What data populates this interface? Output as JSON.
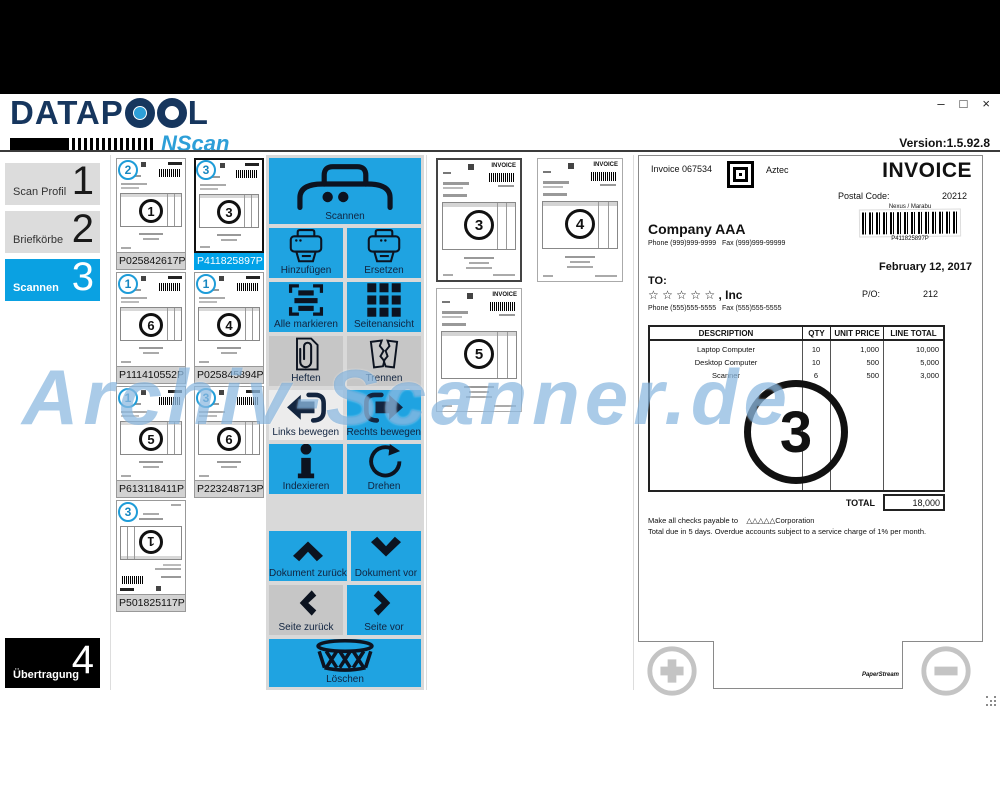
{
  "window": {
    "version": "Version:1.5.92.8",
    "minimize": "‒",
    "maximize": "□",
    "close": "×"
  },
  "brand": {
    "name": "DATAPOOL",
    "name_prefix": "DATAP",
    "name_suffix": "L",
    "product": "NScan"
  },
  "watermark": "Archiv-Scanner.de",
  "colors": {
    "accent_blue": "#1FA3E1",
    "selected_blue": "#00A2E8",
    "badge_blue": "#1E9CD8",
    "gray_button": "#C6C6C6",
    "navy": "#16365E",
    "black_panel": "#000000"
  },
  "sidebar": {
    "items": [
      {
        "label": "Scan Profil",
        "number": "1"
      },
      {
        "label": "Briefkörbe",
        "number": "2"
      },
      {
        "label": "Scannen",
        "number": "3"
      },
      {
        "label": "Übertragung",
        "number": "4"
      }
    ]
  },
  "documents": {
    "items": [
      {
        "badge": "2",
        "page_num": "1",
        "label": "P025842617P"
      },
      {
        "badge": "3",
        "page_num": "3",
        "label": "P411825897P"
      },
      {
        "badge": "1",
        "page_num": "6",
        "label": "P111410552P"
      },
      {
        "badge": "1",
        "page_num": "4",
        "label": "P025845894P"
      },
      {
        "badge": "1",
        "page_num": "5",
        "label": "P613118411P"
      },
      {
        "badge": "3",
        "page_num": "6",
        "label": "P223248713P"
      },
      {
        "badge": "3",
        "page_num": "1",
        "label": "P501825117P"
      }
    ]
  },
  "toolbar": {
    "scan": "Scannen",
    "add": "Hinzufügen",
    "replace": "Ersetzen",
    "mark_all": "Alle markieren",
    "page_view": "Seitenansicht",
    "staple": "Heften",
    "split": "Trennen",
    "move_left": "Links bewegen",
    "move_right": "Rechts bewegen",
    "index": "Indexieren",
    "rotate": "Drehen",
    "doc_back": "Dokument zurück",
    "doc_forward": "Dokument vor",
    "page_back": "Seite zurück",
    "page_forward": "Seite vor",
    "delete": "Löschen"
  },
  "pages": {
    "items": [
      {
        "page_num": "3"
      },
      {
        "page_num": "4"
      },
      {
        "page_num": "5"
      }
    ]
  },
  "invoice": {
    "number": "Invoice 067534",
    "aztec_label": "Aztec",
    "title": "INVOICE",
    "postal_label": "Postal Code:",
    "postal_code": "20212",
    "carrier": "Nexus / Marabu",
    "barcode_value": "P411825897P",
    "company": "Company AAA",
    "company_contact": "Phone (999)999-9999   Fax (999)999-99999",
    "date": "February 12, 2017",
    "to_label": "TO:",
    "recipient": "☆ ☆ ☆ ☆ ☆ , Inc",
    "recipient_contact": "Phone (555)555-5555   Fax (555)555-5555",
    "po_label": "P/O:",
    "po_number": "212",
    "page_num": "3",
    "table": {
      "headers": [
        "DESCRIPTION",
        "QTY",
        "UNIT PRICE",
        "LINE TOTAL"
      ],
      "rows": [
        [
          "Laptop Computer",
          "10",
          "1,000",
          "10,000"
        ],
        [
          "Desktop Computer",
          "10",
          "500",
          "5,000"
        ],
        [
          "Scanner",
          "6",
          "500",
          "3,000"
        ]
      ]
    },
    "total_label": "TOTAL",
    "total": "18,000",
    "note1": "Make all checks payable to    △△△△△Corporation",
    "note2": "Total due in 5 days. Overdue accounts subject to a service charge of 1% per month.",
    "viewer_brand": "PaperStream"
  }
}
